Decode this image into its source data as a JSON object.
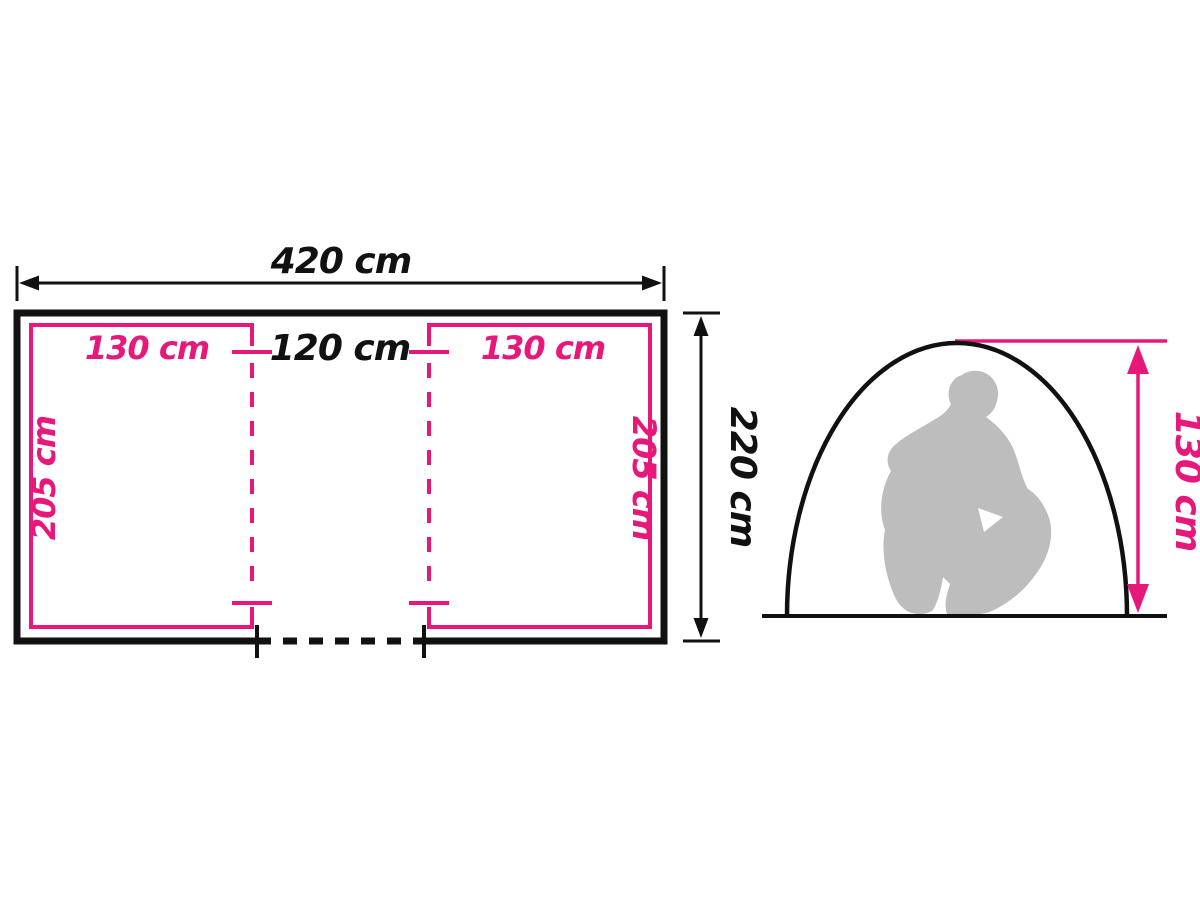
{
  "colors": {
    "dimension_pink": "#e7187a",
    "line_black": "#111111",
    "silhouette_gray": "#bdbdbd",
    "background": "#ffffff"
  },
  "floor_plan": {
    "overall_width": "420 cm",
    "overall_depth": "220 cm",
    "left_cabin_width": "130 cm",
    "center_section_width": "120 cm",
    "right_cabin_width": "130 cm",
    "left_cabin_depth": "205 cm",
    "right_cabin_depth": "205 cm"
  },
  "side_view": {
    "interior_height": "130 cm"
  }
}
